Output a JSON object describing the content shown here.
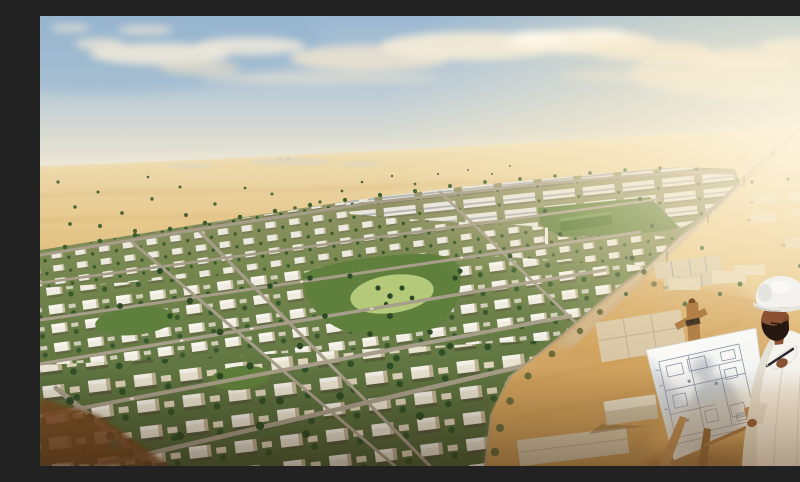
{
  "scene": {
    "description": "Aerial golden-hour rendering of a master-planned desert residential community with white flat-roof villas, apartment blocks, green parks and tree-lined streets, a straight highway vanishing to the horizon, surrounding sand dunes, a construction site with building foundations, and in the foreground an architect in a white thobe and white hard hat sketching architectural floor plans on a large sheet mounted on a wooden easel.",
    "elements": [
      "sky with scattered clouds and warm sun glow",
      "desert dunes with scattered shrubs",
      "highway to horizon",
      "residential community of villas",
      "apartment district",
      "central park with oval lawn and palms",
      "northeast park with green-roof building",
      "construction site with concrete foundations",
      "warehouse buildings on sand",
      "architect figure with hard hat",
      "wooden easel",
      "blueprint floor-plan sheet",
      "drawing pen"
    ]
  },
  "palette": {
    "sky_top": "#9bb8d1",
    "sky_mid": "#c2cfd8",
    "sky_horizon": "#efe7d4",
    "sun_glow": "#fff5df",
    "cloud": "#f4eede",
    "cloud_warm": "#e8ddc7",
    "sand_far": "#eed9a9",
    "sand_mid": "#dcb571",
    "sand_near": "#c9985a",
    "soil": "#7c4a22",
    "lawn": "#5f7f3c",
    "lawn_light": "#b5c97a",
    "tree": "#3d5e2f",
    "tree_dark": "#2c4a24",
    "road": "#a79e8a",
    "highway": "#cfbd9c",
    "villa_wall": "#f0ecdf",
    "villa_roof": "#dcd8cc",
    "apartment": "#e9e6de",
    "concrete": "#d9cdb0",
    "wood": "#b08048",
    "wood_dark": "#7c5327",
    "robe": "#f6f4ee",
    "robe_shade": "#e4e0d5",
    "skin": "#8a5233",
    "beard": "#241810",
    "hardhat": "#f3f2ee",
    "paper": "#fbfaf6",
    "paper_shade": "#a8b0bd",
    "plan_line": "#8a95a4",
    "pen": "#26242a",
    "car_red": "#b03a28",
    "vignette": "#3a2310"
  }
}
